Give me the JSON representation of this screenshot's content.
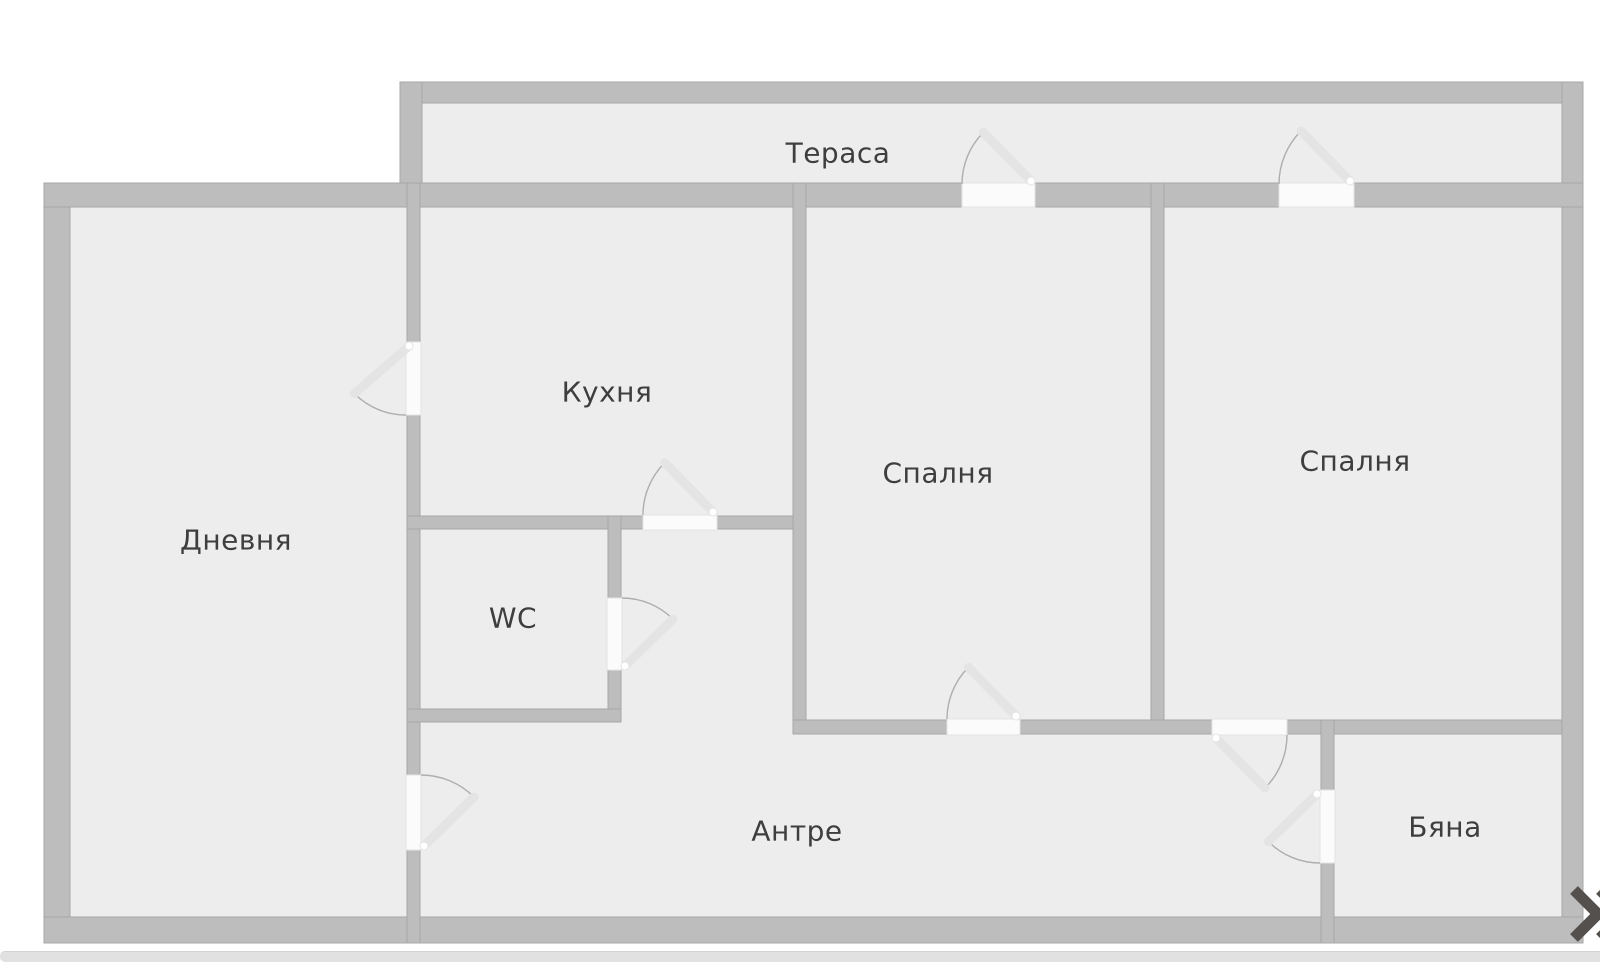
{
  "floor_plan": {
    "title": "Apartment floor plan",
    "rooms": [
      {
        "id": "terrace",
        "label": "Тераса"
      },
      {
        "id": "living",
        "label": "Дневня"
      },
      {
        "id": "kitchen",
        "label": "Кухня"
      },
      {
        "id": "wc",
        "label": "WC"
      },
      {
        "id": "bedroom-1",
        "label": "Спалня"
      },
      {
        "id": "bedroom-2",
        "label": "Спалня"
      },
      {
        "id": "hallway",
        "label": "Антре"
      },
      {
        "id": "bath",
        "label": "Бяна"
      }
    ],
    "colors": {
      "wall_fill": "#bdbdbd",
      "wall_stroke": "#a7a7a7",
      "room_fill": "#ededed",
      "door_gap_fill": "#fbfbfb",
      "door_arc_stroke": "#aeaeae",
      "door_leaf_stroke": "#e4e4e4",
      "label_color": "#3e3e3e",
      "background": "#ffffff"
    },
    "door_count": 9
  },
  "controls": {
    "next_icon": "double-chevron-right",
    "next_icon_color": "#54504e"
  },
  "scrollbar": {
    "color": "#e1e1e1"
  }
}
